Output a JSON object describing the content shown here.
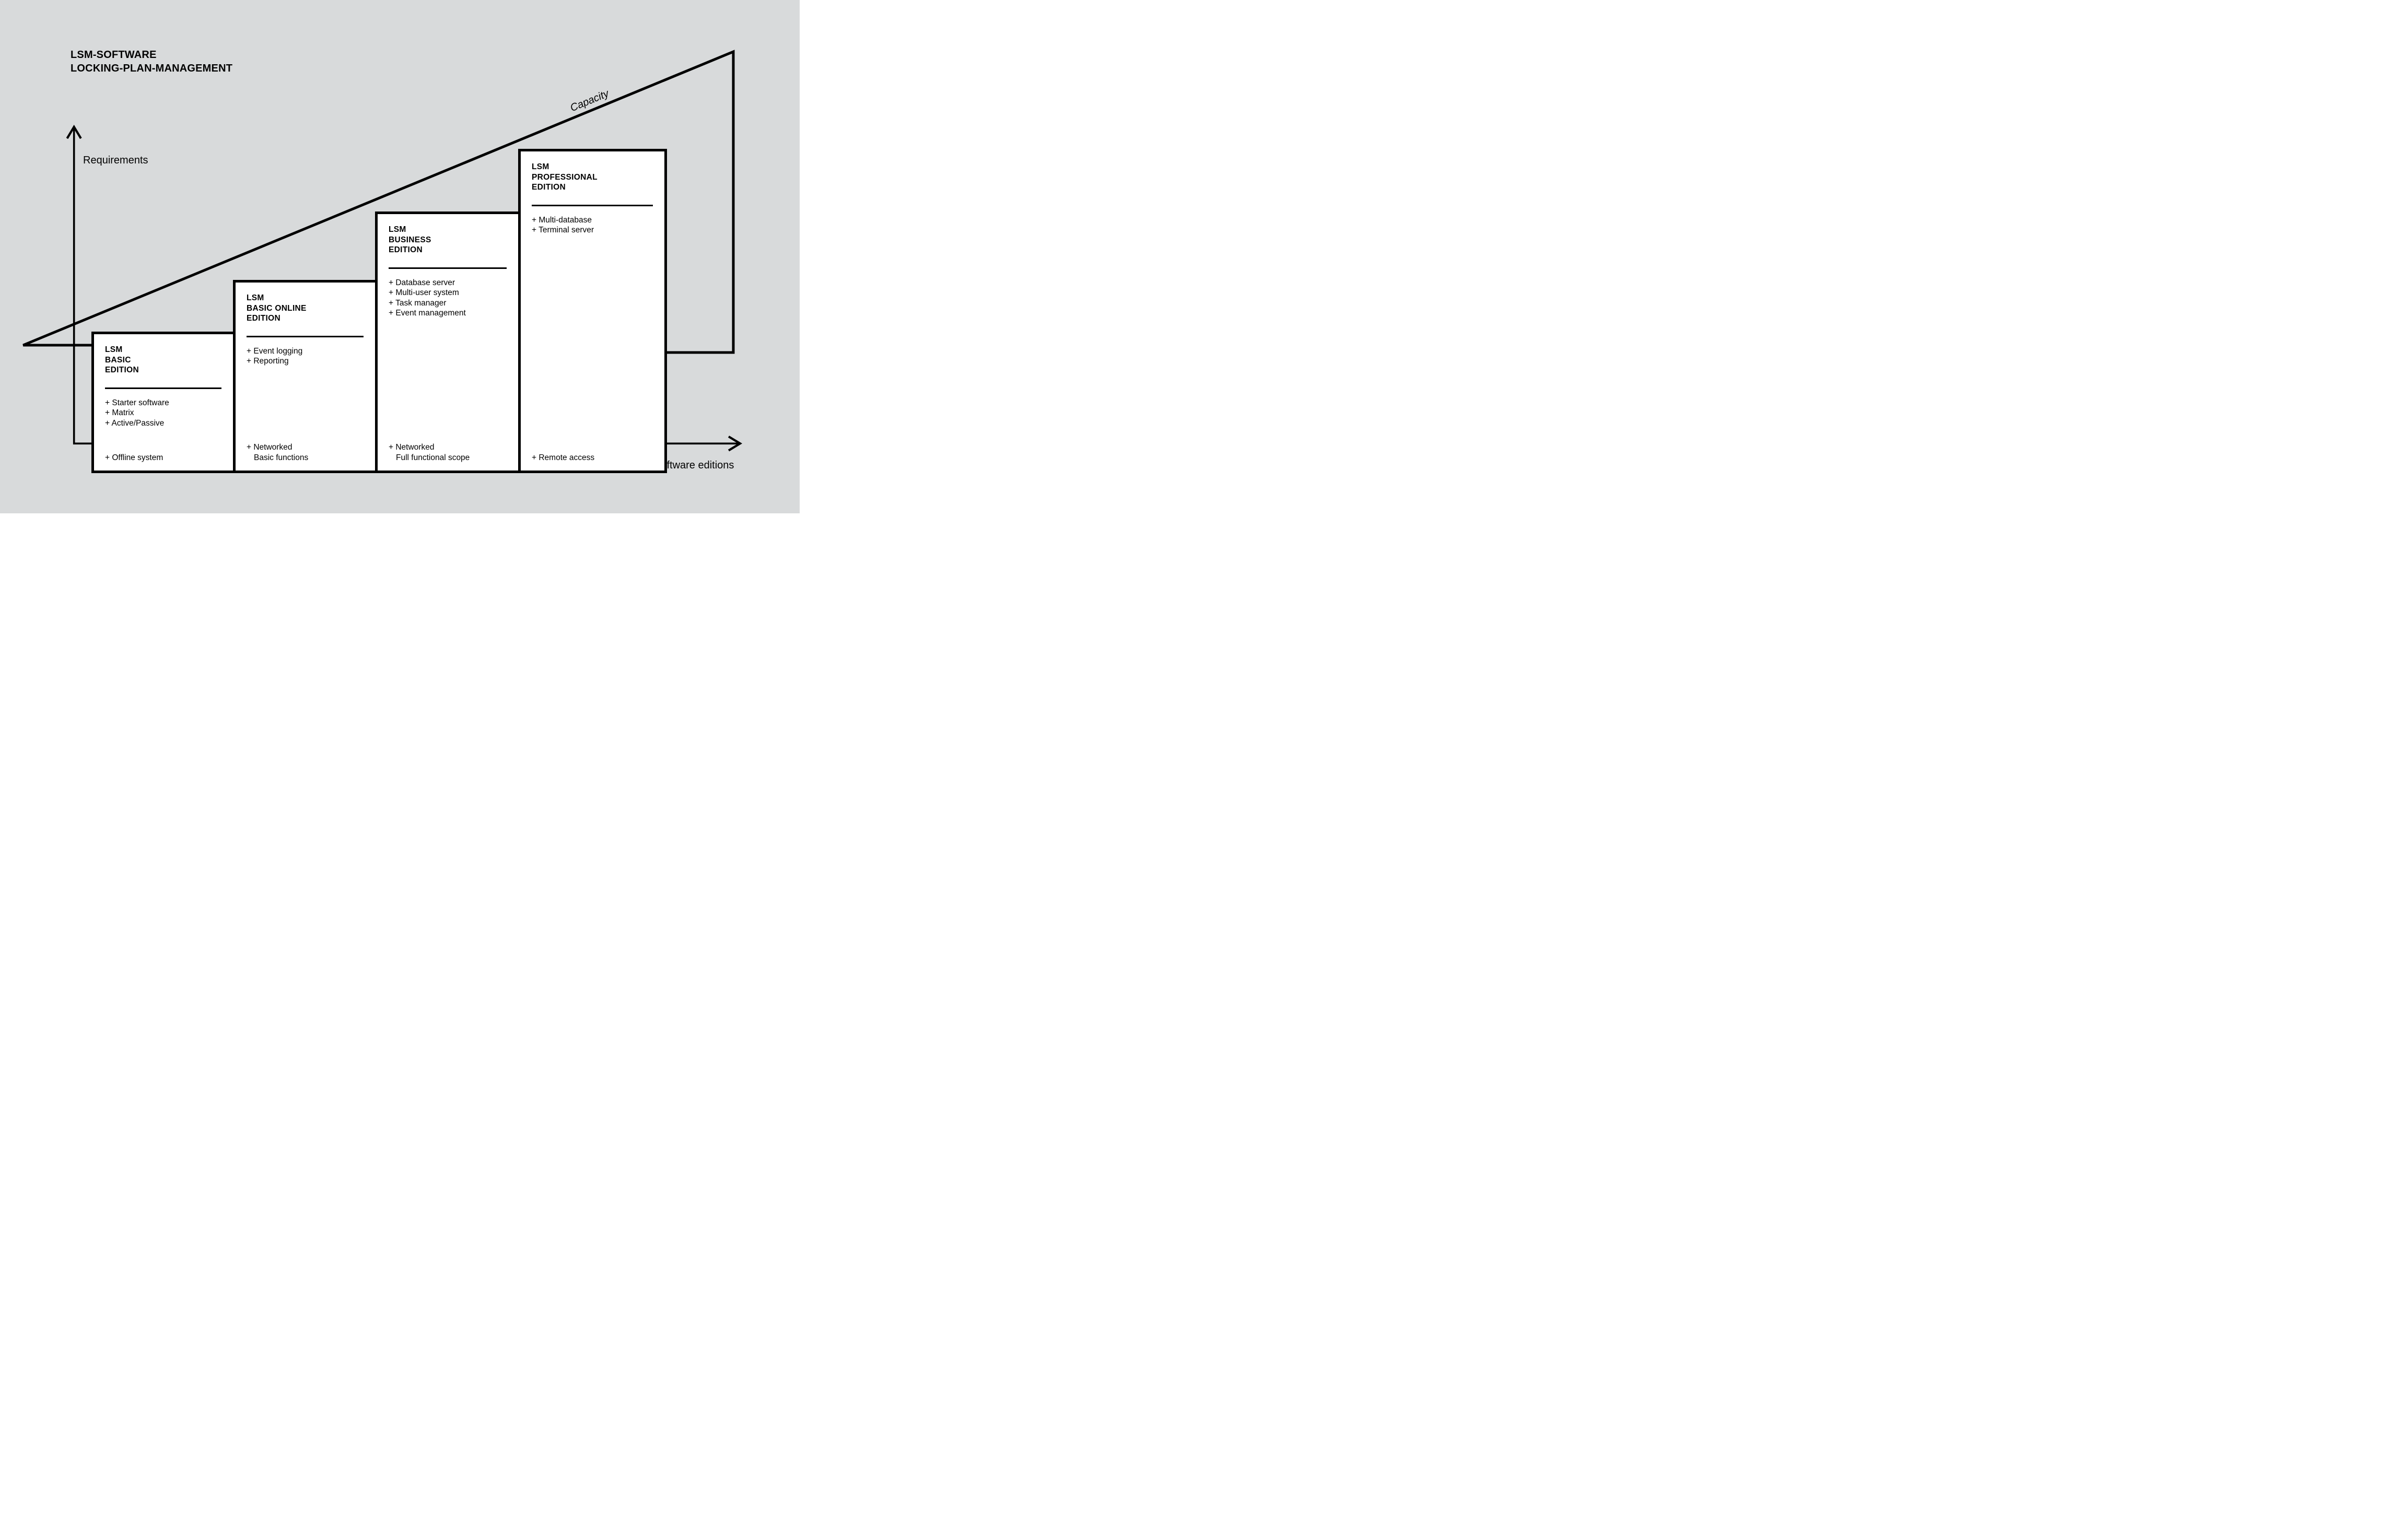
{
  "title": {
    "line1": "LSM-SOFTWARE",
    "line2": "LOCKING-PLAN-MANAGEMENT"
  },
  "axes": {
    "y_label": "Requirements",
    "x_label": "Software editions"
  },
  "capacity_label": "Capacity",
  "colors": {
    "background": "#d8dadb",
    "box_fill": "#ffffff",
    "line": "#000000"
  },
  "boxes": [
    {
      "id": "basic",
      "heading": [
        "LSM",
        "BASIC",
        "EDITION"
      ],
      "features": [
        "+ Starter software",
        "+ Matrix",
        "+ Active/Passive"
      ],
      "bottom_features": [
        "+ Offline system"
      ]
    },
    {
      "id": "basic-online",
      "heading": [
        "LSM",
        "BASIC ONLINE",
        "EDITION"
      ],
      "features": [
        "+ Event logging",
        "+ Reporting"
      ],
      "bottom_features": [
        "+ Networked",
        "Basic functions"
      ]
    },
    {
      "id": "business",
      "heading": [
        "LSM",
        "BUSINESS",
        "EDITION"
      ],
      "features": [
        "+ Database server",
        "+ Multi-user system",
        "+ Task manager",
        "+ Event management"
      ],
      "bottom_features": [
        "+ Networked",
        "Full functional scope"
      ]
    },
    {
      "id": "professional",
      "heading": [
        "LSM",
        "PROFESSIONAL",
        "EDITION"
      ],
      "features": [
        "+ Multi-database",
        "+ Terminal server"
      ],
      "bottom_features": [
        "+ Remote access"
      ]
    }
  ]
}
